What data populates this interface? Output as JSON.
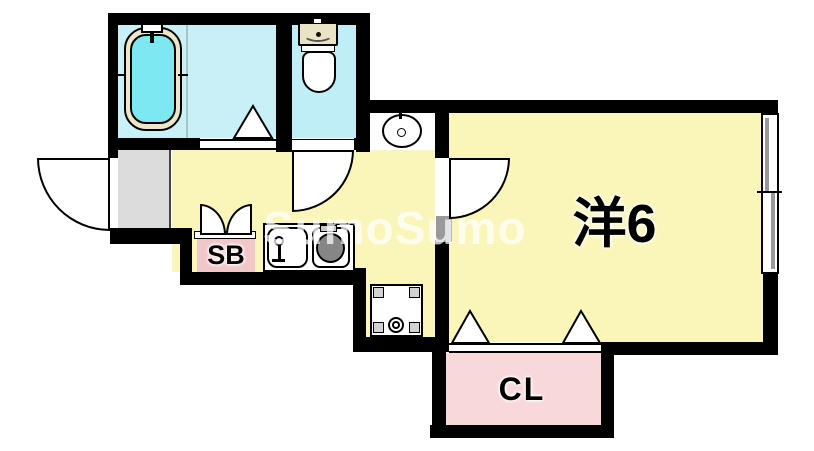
{
  "plan_type": "floor-plan",
  "watermark": {
    "text": "SumoSumo"
  },
  "rooms": {
    "western_room": {
      "label": "洋6"
    },
    "shoe_box": {
      "label": "SB"
    },
    "closet": {
      "label": "CL"
    }
  },
  "fixtures": [
    "bathtub",
    "bath-faucet",
    "folding-bath-door",
    "toilet",
    "washbasin",
    "entrance-door",
    "toilet-door",
    "room-door",
    "shoe-box-double-doors",
    "kitchen-sink",
    "stove-burner",
    "washing-machine-pan",
    "closet-folding-doors",
    "sliding-window"
  ],
  "colors": {
    "wall": "#000000",
    "floor_yellow": "#faf6ba",
    "bathroom_cyan": "#c9f0f7",
    "bath_water": "#7de8ef",
    "tub_rim_cream": "#eee6c9",
    "genkan_gray": "#dcdcdc",
    "closet_pink": "#f8d8d8",
    "shoebox_pink": "#f2c7c9"
  }
}
